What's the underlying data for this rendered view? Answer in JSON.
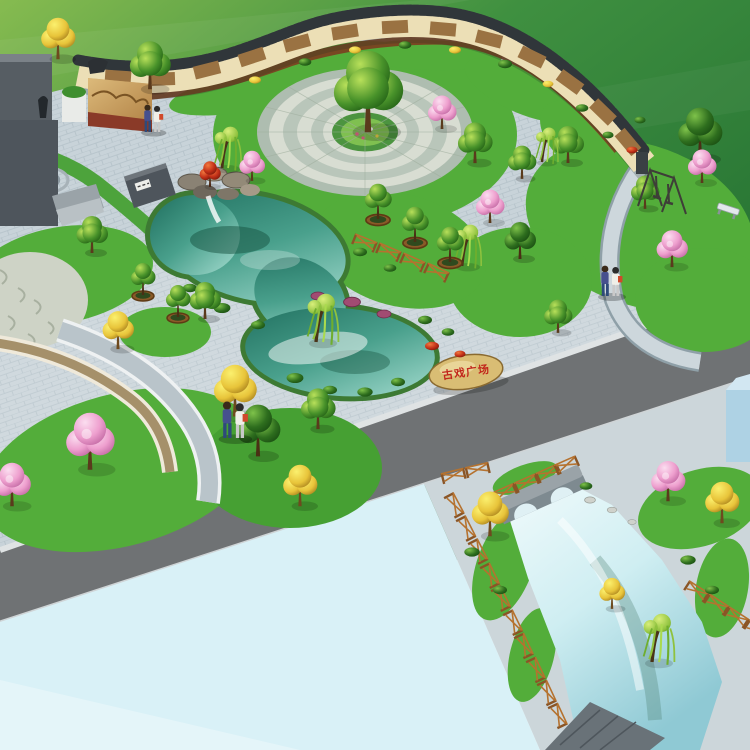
{
  "scene": {
    "type": "landscape-architecture-aerial-rendering",
    "setting": "cultural plaza park with mural wall, circular plaza, pond, lawns and canal garden"
  },
  "inscription_stone": {
    "text": "古戏广场",
    "text_color": "#c2271c"
  },
  "palette": {
    "field_green": "#3a8a3c",
    "plaza_paving": "#c8d3d9",
    "plaza_joint": "#b3c1c8",
    "road_asphalt": "#6f7274",
    "water_plane": "#d9f1f7",
    "canal_paving": "#ccd6da",
    "pond_water": "#49a08c",
    "lawn_green": "#53ad3a",
    "wall_face": "#ecdfb6",
    "wall_coping": "#30363a",
    "mural_sepia": "#9a7242",
    "mulch_brown": "#7c3d20",
    "fence_wood": "#a9692c",
    "bridge_stone": "#9aa3a8",
    "stone_tan": "#d9bd74",
    "monument_gray": "#565d63",
    "relief_gold": "#c99e5c",
    "blue_structure": "#aed2e4"
  }
}
